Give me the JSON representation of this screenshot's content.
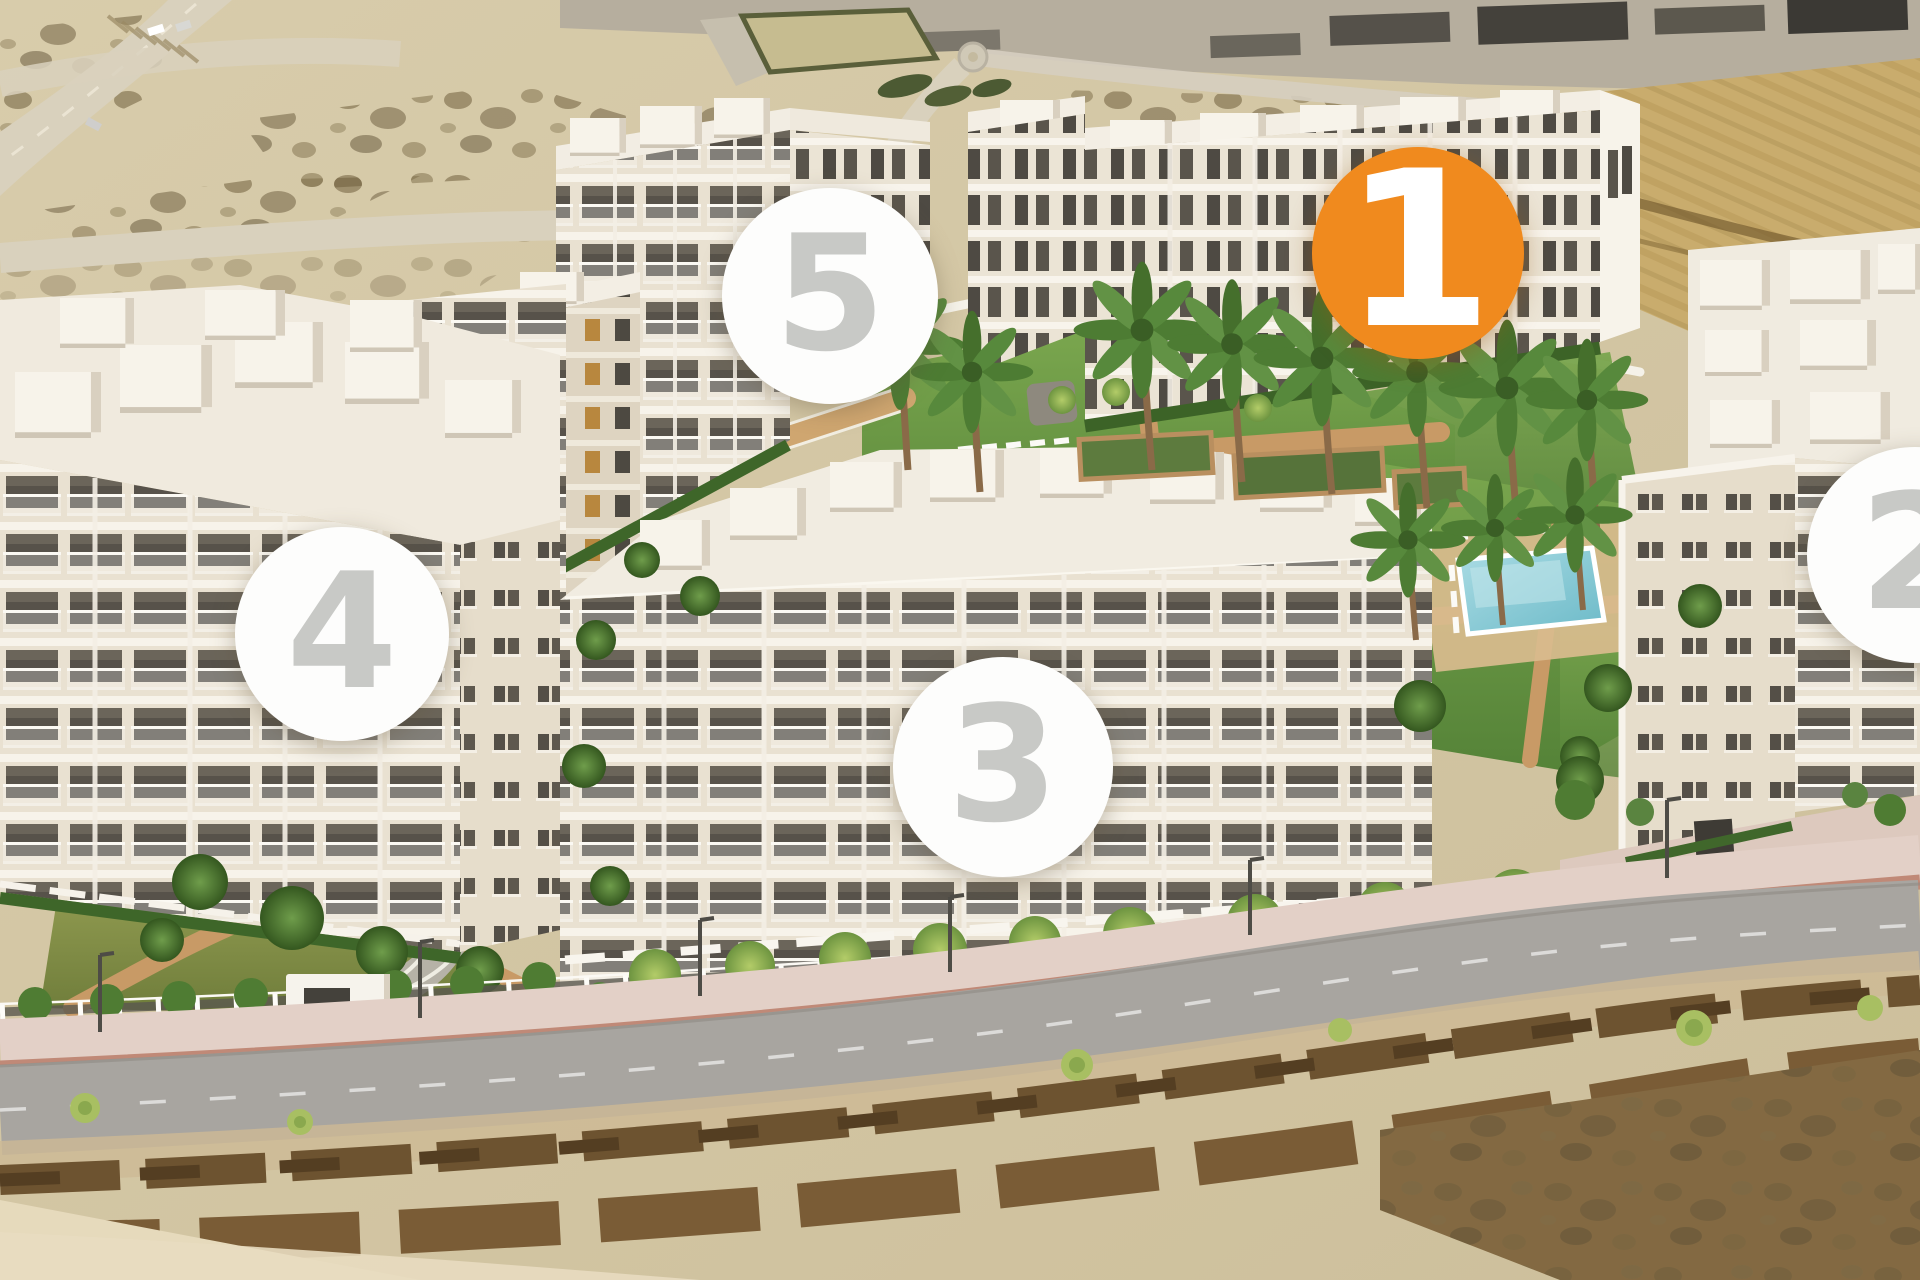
{
  "page": {
    "description": "Aerial 3D render of a five-building residential development with central gardens, two swimming pools, palm trees, perimeter fence and a curved road in front; vacant sandy land and roads around it"
  },
  "scene": {
    "colors": {
      "sand": "#d5c8a6",
      "scrub_dark": "#6b5a38",
      "back_road": "#d9d1bd",
      "main_road": "#a8a5a0",
      "sidewalk_pink": "#decabe",
      "paver_brick": "#b57f6e",
      "building_facade": "#e9e1d1",
      "building_roof": "#f3efe6",
      "window_glass": "#57524a",
      "lawn_green": "#63923f",
      "olive_lawn": "#7b8a45",
      "hedge_green": "#3e6629",
      "path_terracotta": "#c89a66",
      "pool_blue": "#7cc4d0",
      "lap_pool_teal": "#2f6b70",
      "excavation": "#c9ac6d"
    }
  },
  "markers": {
    "selected_bg": "#f08a1e",
    "selected_text_color": "#ffffff",
    "default_bg": "#fdfdfc",
    "default_text_color": "#c8c9c6",
    "items": [
      {
        "label": "1",
        "x": 1418,
        "y": 253,
        "diameter": 212,
        "state": "selected"
      },
      {
        "label": "2",
        "x": 1915,
        "y": 555,
        "diameter": 216,
        "state": "default"
      },
      {
        "label": "3",
        "x": 1003,
        "y": 767,
        "diameter": 220,
        "state": "default"
      },
      {
        "label": "4",
        "x": 342,
        "y": 634,
        "diameter": 214,
        "state": "default"
      },
      {
        "label": "5",
        "x": 830,
        "y": 296,
        "diameter": 216,
        "state": "default"
      }
    ]
  }
}
